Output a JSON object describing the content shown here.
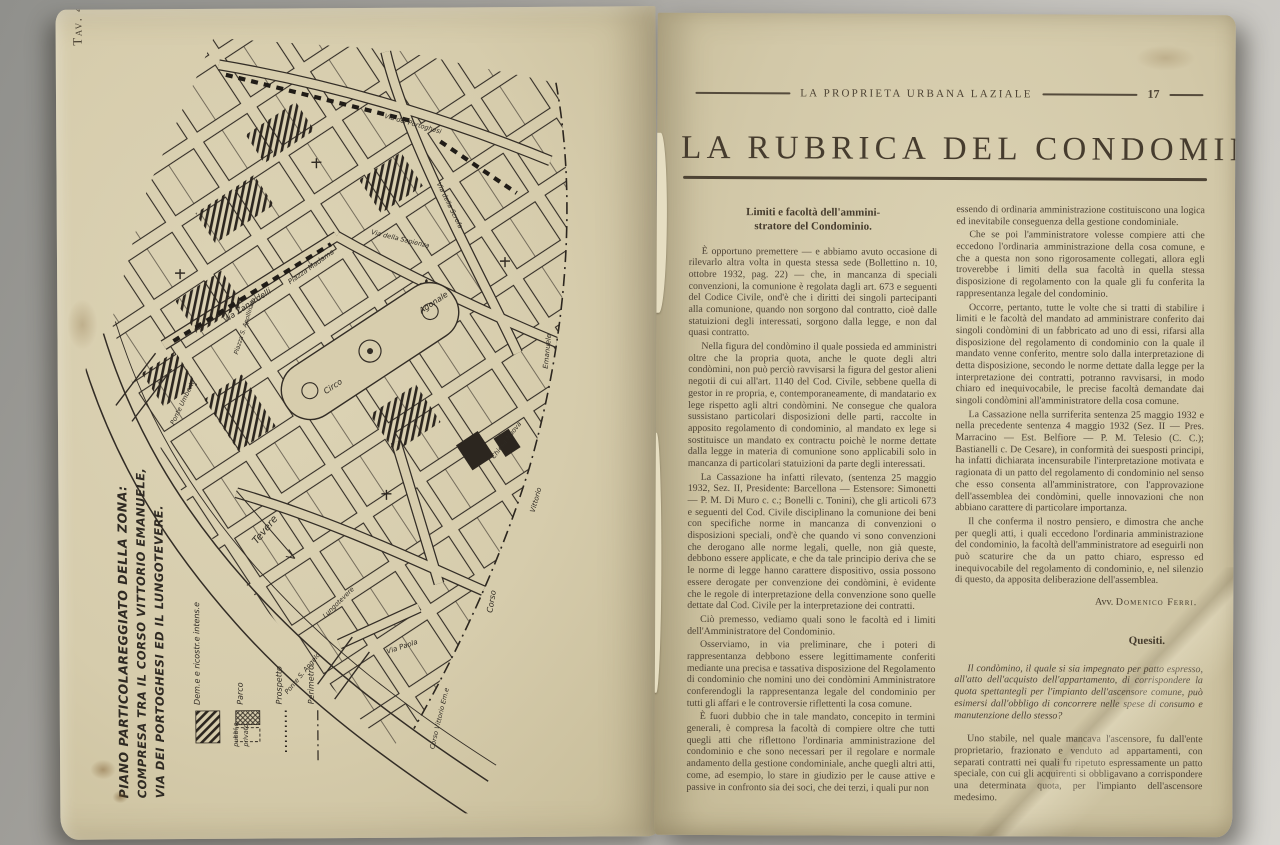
{
  "left_page": {
    "plate_label": "Tav. 4.",
    "map": {
      "caption_lines": [
        "PIANO PARTICOLAREGGIATO DELLA ZONA:",
        "COMPRESA TRA IL CORSO VITTORIO EMANUELE,",
        "VIA DEI PORTOGHESI ED IL LUNGOTEVERE."
      ],
      "legend": {
        "demolition": "Dem.e e ricostr.e intens.e",
        "parco": "Parco",
        "parco_pubblico": "pubbl.o",
        "parco_privato": "privato",
        "prospetto": "Prospetto",
        "perimetro": "Perimetro"
      },
      "labels": {
        "piazza_madama": "Piazza Madama",
        "circo": "Circo",
        "agonale": "Agonale",
        "via_zanardelli": "Via Zanardelli",
        "ponte_umberto": "Ponte Umberto",
        "tevere": "Tevere",
        "lungotevere": "Lungotevere",
        "ponte_s_angelo": "Ponte S. Angelo",
        "via_paola": "Via Paola",
        "corso": "Corso",
        "vittorio": "Vittorio",
        "emanuele": "Emanuele",
        "corso_vittorio_em": "Corso Vittorio Em.e",
        "via_portoghesi": "Via dei Portoghesi",
        "via_scrofa": "Via della Scrofa",
        "piazza_apollinare": "Piazza S. Apollinare",
        "via_sapienza": "Via della Sapienza",
        "chiesa_nuova": "Chiesa Nuova"
      },
      "ink_color": "#332d26",
      "paper_color": "#d7cdad"
    }
  },
  "right_page": {
    "masthead": {
      "journal": "LA PROPRIETA URBANA LAZIALE",
      "page_number": "17"
    },
    "title": "LA RUBRICA DEL CONDOMINIO",
    "article": {
      "heading_line1": "Limiti e facoltà dell'ammini-",
      "heading_line2": "stratore del Condominio.",
      "col1": [
        "È opportuno premettere — e abbiamo avuto occasione di rilevarlo altra volta in questa stessa sede (Bollettino n. 10, ottobre 1932, pag. 22) — che, in mancanza di speciali convenzioni, la comunione è regolata dagli art. 673 e seguenti del Codice Civile, ond'è che i diritti dei singoli partecipanti alla comunione, quando non sorgono dal contratto, cioè dalle statuizioni degli interessati, sorgono dalla legge, e non dal quasi contratto.",
        "Nella figura del condòmino il quale possieda ed amministri oltre che la propria quota, anche le quote degli altri condòmini, non può perciò ravvisarsi la figura del gestor alieni negotii di cui all'art. 1140 del Cod. Civile, sebbene quella di gestor in re propria, e, contemporaneamente, di mandatario ex lege rispetto agli altri condòmini. Ne consegue che qualora sussistano particolari disposizioni delle parti, raccolte in apposito regolamento di condominio, al mandato ex lege si sostituisce un mandato ex contractu poichè le norme dettate dalla legge in materia di comunione sono applicabili solo in mancanza di particolari statuizioni da parte degli interessati.",
        "La Cassazione ha infatti rilevato, (sentenza 25 maggio 1932, Sez. II, Presidente: Barcellona — Estensore: Simonetti — P. M. Di Muro c. c.; Bonelli c. Tonini), che gli articoli 673 e seguenti del Cod. Civile disciplinano la comunione dei beni con specifiche norme in mancanza di convenzioni o disposizioni speciali, ond'è che quando vi sono convenzioni che derogano alle norme legali, quelle, non già queste, debbono essere applicate, e che da tale principio deriva che se le norme di legge hanno carattere dispositivo, ossia possono essere derogate per convenzione dei condòmini, è evidente che le regole di interpretazione della convenzione sono quelle dettate dal Cod. Civile per la interpretazione dei contratti.",
        "Ciò premesso, vediamo quali sono le facoltà ed i limiti dell'Amministratore del Condominio.",
        "Osserviamo, in via preliminare, che i poteri di rappresentanza debbono essere legittimamente conferiti mediante una precisa e tassativa disposizione del Regolamento di condominio che nomini uno dei condòmini Amministratore conferendogli la rappresentanza legale del condominio per tutti gli affari e le controversie riflettenti la cosa comune.",
        "È fuori dubbio che in tale mandato, concepito in termini generali, è compresa la facoltà di compiere oltre che tutti quegli atti che riflettono l'ordinaria amministrazione del condominio e che sono necessari per il regolare e normale andamento della gestione condominiale, anche quegli altri atti, come, ad esempio, lo stare in giudizio per le cause attive e passive in confronto sia dei soci, che dei terzi, i quali pur non"
      ],
      "col2": [
        "essendo di ordinaria amministrazione costituiscono una logica ed inevitabile conseguenza della gestione condominiale.",
        "Che se poi l'amministratore volesse compiere atti che eccedono l'ordinaria amministrazione della cosa comune, e che a questa non sono rigorosamente collegati, allora egli troverebbe i limiti della sua facoltà in quella stessa disposizione di regolamento con la quale gli fu conferita la rappresentanza legale del condominio.",
        "Occorre, pertanto, tutte le volte che si tratti di stabilire i limiti e le facoltà del mandato ad amministrare conferito dai singoli condòmini di un fabbricato ad uno di essi, rifarsi alla disposizione del regolamento di condominio con la quale il mandato venne conferito, mentre solo dalla interpretazione di detta disposizione, secondo le norme dettate dalla legge per la interpretazione dei contratti, potranno ravvisarsi, in modo chiaro ed inequivocabile, le precise facoltà demandate dai singoli condòmini all'amministratore della cosa comune.",
        "La Cassazione nella surriferita sentenza 25 maggio 1932 e nella precedente sentenza 4 maggio 1932 (Sez. II — Pres. Marracino — Est. Belfiore — P. M. Telesio (C. C.); Bastianelli c. De Cesare), in conformità dei suesposti principi, ha infatti dichiarata incensurabile l'interpretazione motivata e ragionata di un patto del regolamento di condominio nel senso che esso consenta all'amministratore, con l'approvazione dell'assemblea dei condòmini, quelle innovazioni che non abbiano carattere di particolare importanza.",
        "Il che conferma il nostro pensiero, e dimostra che anche per quegli atti, i quali eccedono l'ordinaria amministrazione del condominio, la facoltà dell'amministratore ad eseguirli non può scaturire che da un patto chiaro, espresso ed inequivocabile del regolamento di condominio, e, nel silenzio di questo, da apposita deliberazione dell'assemblea."
      ],
      "signature_prefix": "Avv. ",
      "signature_name": "Domenico Ferri.",
      "quesiti_heading": "Quesiti.",
      "quesiti_question": "Il condòmino, il quale si sia impegnato per patto espresso, all'atto dell'acquisto dell'appartamento, di corrispondere la quota spettantegli per l'impianto dell'ascensore comune, può esimersi dall'obbligo di concorrere nelle spese di consumo e manutenzione dello stesso?",
      "quesiti_answer": "Uno stabile, nel quale mancava l'ascensore, fu dall'ente proprietario, frazionato e venduto ad appartamenti, con separati contratti nei quali fu ripetuto espressamente un patto speciale, con cui gli acquirenti si obbligavano a corrispondere una determinata quota, per l'impianto dell'ascensore medesimo."
    }
  }
}
